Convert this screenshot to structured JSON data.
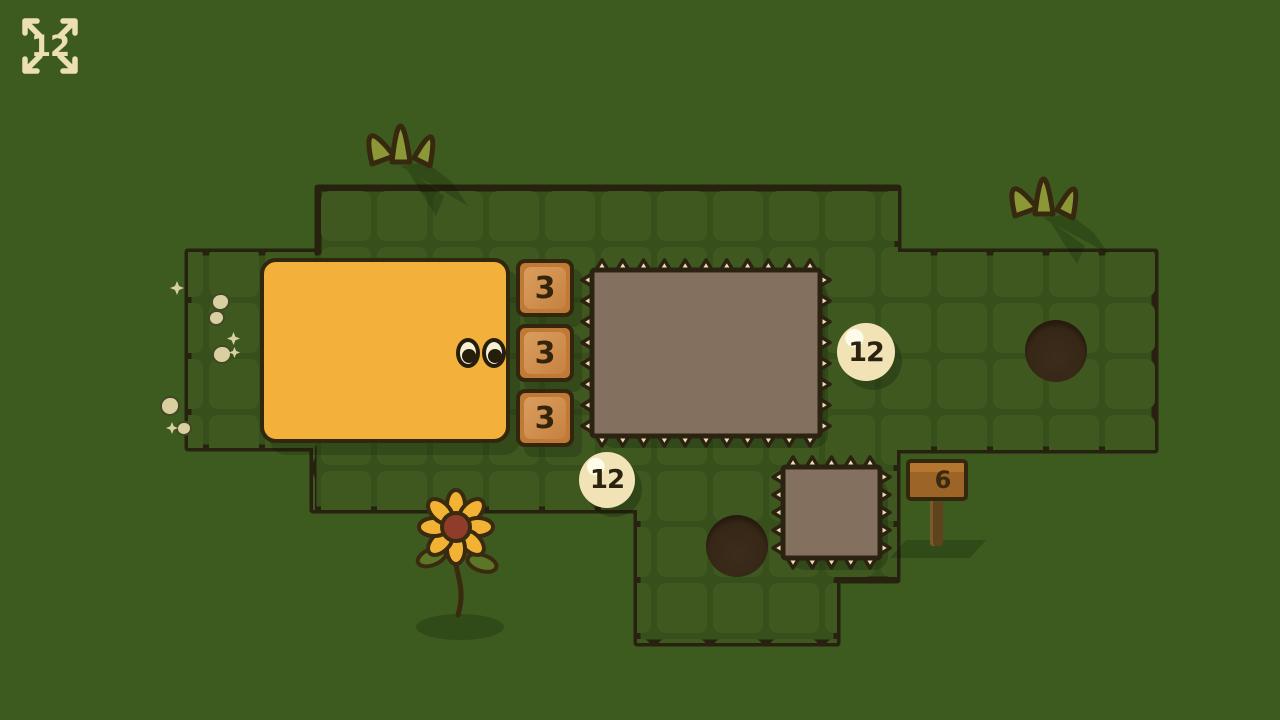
{
  "hud": {
    "expand": {
      "icon": "expand-arrows-icon",
      "value": "12"
    }
  },
  "crates": {
    "items": [
      {
        "label": "3"
      },
      {
        "label": "3"
      },
      {
        "label": "3"
      }
    ]
  },
  "zones": {
    "large": {
      "badge": "12"
    },
    "small": {
      "badge": "12"
    }
  },
  "sign": {
    "label": "6"
  },
  "palette": {
    "background_green": "#3d5a1f",
    "board_green": "#37501b",
    "tile_green": "#3e5820",
    "outline_dark": "#2c2212",
    "player_yellow": "#f3b03a",
    "crate_orange": "#c17938",
    "zone_taupe": "#84705f",
    "cream": "#efe0b3",
    "sign_brown": "#9c6426",
    "hole_brown": "#352615"
  }
}
